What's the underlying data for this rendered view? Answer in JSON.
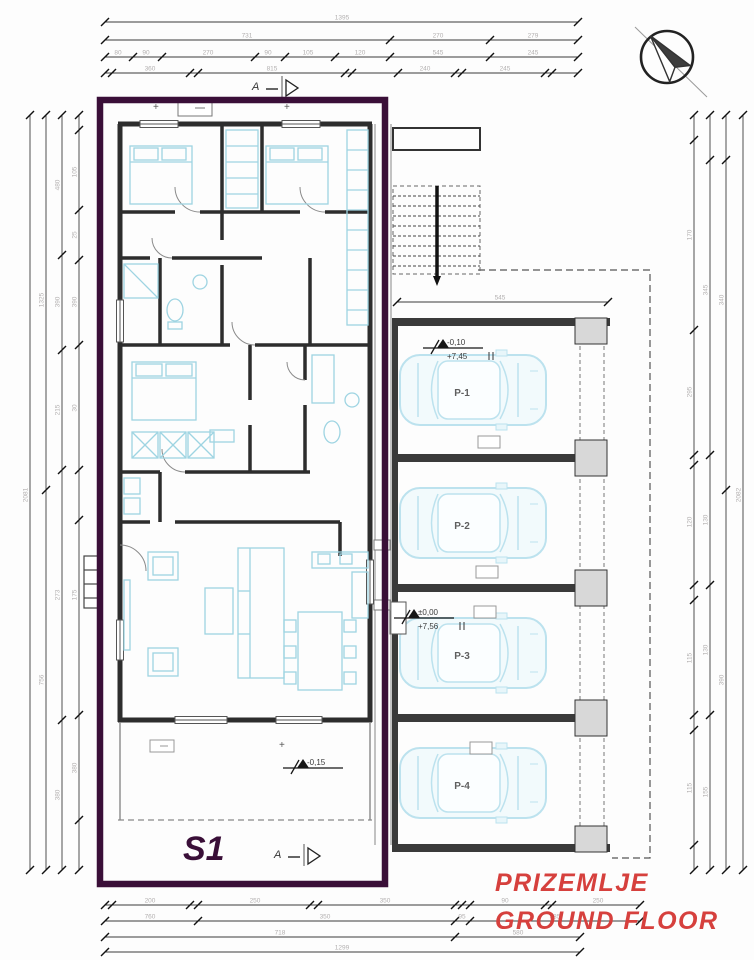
{
  "title": {
    "hr": "PRIZEMLJE",
    "en": "GROUND FLOOR"
  },
  "unit_label": "S1",
  "section_marker": "A",
  "parking": {
    "bays": [
      {
        "label": "P-1"
      },
      {
        "label": "P-2"
      },
      {
        "label": "P-3"
      },
      {
        "label": "P-4"
      }
    ]
  },
  "elevations": {
    "parking_upper": "-0,10",
    "parking_lower": "+7,45",
    "entry_upper": "±0,00",
    "entry_lower": "+7,56",
    "terrace": "-0,15"
  },
  "colors": {
    "outline_purple": "#3A0F38",
    "text_red": "#D6403D",
    "furniture_cyan": "#9ED4E2",
    "car_cyan": "#BCE2EE",
    "walls": "#2D2D2D",
    "dim_text": "#B3B0B0"
  },
  "dims": {
    "rows": [
      {
        "o": "h",
        "pos": 22,
        "a1": 105,
        "a2": 578,
        "ticks": [
          105,
          578
        ],
        "labels": [
          {
            "p": 342,
            "t": "1395"
          }
        ]
      },
      {
        "o": "h",
        "pos": 40,
        "a1": 105,
        "a2": 578,
        "ticks": [
          105,
          390,
          490,
          578
        ],
        "labels": [
          {
            "p": 247,
            "t": "731"
          },
          {
            "p": 438,
            "t": "270"
          },
          {
            "p": 533,
            "t": "279"
          }
        ]
      },
      {
        "o": "h",
        "pos": 57,
        "a1": 105,
        "a2": 578,
        "ticks": [
          105,
          133,
          162,
          255,
          285,
          335,
          390,
          490,
          578
        ],
        "labels": [
          {
            "p": 118,
            "t": "80"
          },
          {
            "p": 146,
            "t": "90"
          },
          {
            "p": 208,
            "t": "270"
          },
          {
            "p": 268,
            "t": "90"
          },
          {
            "p": 308,
            "t": "105"
          },
          {
            "p": 360,
            "t": "120"
          },
          {
            "p": 438,
            "t": "545"
          },
          {
            "p": 533,
            "t": "245"
          }
        ]
      },
      {
        "o": "h",
        "pos": 73,
        "a1": 105,
        "a2": 578,
        "ticks": [
          105,
          112,
          190,
          198,
          345,
          352,
          398,
          455,
          462,
          545,
          552,
          578
        ],
        "labels": [
          {
            "p": 150,
            "t": "360"
          },
          {
            "p": 272,
            "t": "815"
          },
          {
            "p": 425,
            "t": "240"
          },
          {
            "p": 505,
            "t": "245"
          }
        ]
      },
      {
        "o": "h",
        "pos": 302,
        "a1": 397,
        "a2": 608,
        "ticks": [
          397,
          608
        ],
        "labels": [
          {
            "p": 500,
            "t": "545"
          }
        ]
      },
      {
        "o": "h",
        "pos": 905,
        "a1": 105,
        "a2": 640,
        "ticks": [
          105,
          112,
          190,
          198,
          310,
          318,
          455,
          462,
          470,
          545,
          552,
          640
        ],
        "labels": [
          {
            "p": 150,
            "t": "200"
          },
          {
            "p": 255,
            "t": "250"
          },
          {
            "p": 385,
            "t": "350"
          },
          {
            "p": 505,
            "t": "90"
          },
          {
            "p": 598,
            "t": "250"
          }
        ]
      },
      {
        "o": "h",
        "pos": 921,
        "a1": 105,
        "a2": 640,
        "ticks": [
          105,
          198,
          455,
          470,
          640
        ],
        "labels": [
          {
            "p": 150,
            "t": "760"
          },
          {
            "p": 325,
            "t": "350"
          },
          {
            "p": 462,
            "t": "95"
          },
          {
            "p": 555,
            "t": "585"
          }
        ]
      },
      {
        "o": "h",
        "pos": 937,
        "a1": 105,
        "a2": 580,
        "ticks": [
          105,
          455,
          580
        ],
        "labels": [
          {
            "p": 280,
            "t": "718"
          },
          {
            "p": 518,
            "t": "580"
          }
        ]
      },
      {
        "o": "h",
        "pos": 952,
        "a1": 105,
        "a2": 580,
        "ticks": [
          105,
          580
        ],
        "labels": [
          {
            "p": 342,
            "t": "1299"
          }
        ]
      },
      {
        "o": "v",
        "pos": 30,
        "a1": 115,
        "a2": 870,
        "ticks": [
          115,
          870
        ],
        "labels": [
          {
            "p": 495,
            "t": "2081"
          }
        ]
      },
      {
        "o": "v",
        "pos": 46,
        "a1": 115,
        "a2": 870,
        "ticks": [
          115,
          490,
          870
        ],
        "labels": [
          {
            "p": 300,
            "t": "1325"
          },
          {
            "p": 680,
            "t": "756"
          }
        ]
      },
      {
        "o": "v",
        "pos": 62,
        "a1": 115,
        "a2": 870,
        "ticks": [
          115,
          255,
          350,
          470,
          720,
          870
        ],
        "labels": [
          {
            "p": 185,
            "t": "480"
          },
          {
            "p": 302,
            "t": "390"
          },
          {
            "p": 410,
            "t": "215"
          },
          {
            "p": 595,
            "t": "273"
          },
          {
            "p": 795,
            "t": "380"
          }
        ]
      },
      {
        "o": "v",
        "pos": 79,
        "a1": 115,
        "a2": 870,
        "ticks": [
          115,
          130,
          210,
          260,
          345,
          470,
          520,
          715,
          820,
          870
        ],
        "labels": [
          {
            "p": 172,
            "t": "105"
          },
          {
            "p": 235,
            "t": "25"
          },
          {
            "p": 302,
            "t": "390"
          },
          {
            "p": 408,
            "t": "30"
          },
          {
            "p": 595,
            "t": "175"
          },
          {
            "p": 768,
            "t": "380"
          }
        ]
      },
      {
        "o": "v",
        "pos": 694,
        "a1": 115,
        "a2": 870,
        "ticks": [
          115,
          140,
          330,
          455,
          465,
          585,
          600,
          715,
          730,
          845,
          870
        ],
        "labels": [
          {
            "p": 235,
            "t": "170"
          },
          {
            "p": 392,
            "t": "295"
          },
          {
            "p": 522,
            "t": "120"
          },
          {
            "p": 658,
            "t": "115"
          },
          {
            "p": 788,
            "t": "115"
          }
        ]
      },
      {
        "o": "v",
        "pos": 710,
        "a1": 115,
        "a2": 870,
        "ticks": [
          115,
          160,
          455,
          585,
          715,
          870
        ],
        "labels": [
          {
            "p": 290,
            "t": "345"
          },
          {
            "p": 520,
            "t": "130"
          },
          {
            "p": 650,
            "t": "130"
          },
          {
            "p": 792,
            "t": "155"
          }
        ]
      },
      {
        "o": "v",
        "pos": 726,
        "a1": 115,
        "a2": 870,
        "ticks": [
          115,
          160,
          490,
          870
        ],
        "labels": [
          {
            "p": 300,
            "t": "340"
          },
          {
            "p": 680,
            "t": "390"
          }
        ]
      },
      {
        "o": "v",
        "pos": 743,
        "a1": 115,
        "a2": 870,
        "ticks": [
          115,
          870
        ],
        "labels": [
          {
            "p": 495,
            "t": "2082"
          }
        ]
      }
    ]
  }
}
